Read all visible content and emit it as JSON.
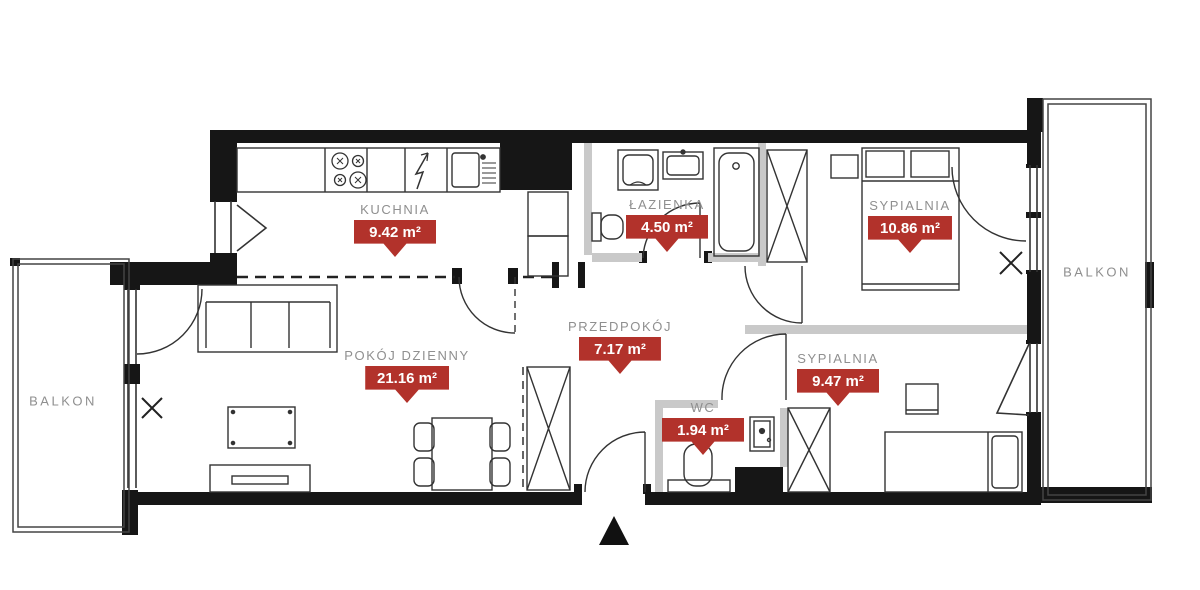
{
  "plan": {
    "rooms": [
      {
        "name": "KUCHNIA",
        "area": "9.42 m²"
      },
      {
        "name": "ŁAZIENKA",
        "area": "4.50 m²"
      },
      {
        "name": "SYPIALNIA",
        "area": "10.86 m²"
      },
      {
        "name": "POKÓJ DZIENNY",
        "area": "21.16 m²"
      },
      {
        "name": "PRZEDPOKÓJ",
        "area": "7.17 m²"
      },
      {
        "name": "WC",
        "area": "1.94 m²"
      },
      {
        "name": "SYPIALNIA",
        "area": "9.47 m²"
      }
    ],
    "balconies": [
      {
        "name": "BALKON"
      },
      {
        "name": "BALKON"
      }
    ],
    "symbols": [
      "entrance-triangle-marker",
      "door-swing-arc",
      "window-tilt-triangle",
      "window-x-mark",
      "kitchen-counter",
      "stove-burners",
      "electric-bolt",
      "kitchen-sink",
      "fridge-cabinets",
      "washing-machine",
      "bathroom-sink",
      "toilet",
      "bathtub",
      "wardrobe-x",
      "double-bed",
      "single-bed",
      "nightstand",
      "desk",
      "sofa",
      "coffee-table",
      "tv-stand",
      "dining-table-chairs",
      "wc-toilet",
      "electrical-panel"
    ],
    "colors": {
      "wall": "#161616",
      "partition": "#c9c9c9",
      "badge": "#b2322b",
      "label": "#8f8f8f",
      "line": "#333333"
    }
  }
}
